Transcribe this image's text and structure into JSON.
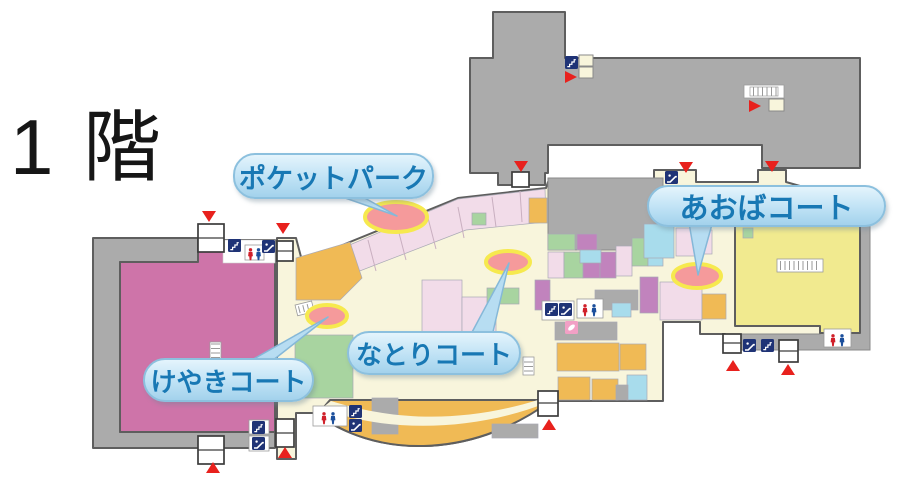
{
  "floor_map": {
    "title": "1 階",
    "courts": [
      {
        "id": "pocket-park",
        "label": "ポケットパーク"
      },
      {
        "id": "aoba-court",
        "label": "あおばコート"
      },
      {
        "id": "natori-court",
        "label": "なとりコート"
      },
      {
        "id": "keyaki-court",
        "label": "けやきコート"
      }
    ],
    "icons": [
      "stairs-icon",
      "escalator-icon",
      "toilet-icon",
      "nursing-room-icon",
      "stairwell-icon",
      "entrance-arrow-icon",
      "entrance-vestibule"
    ],
    "colors": {
      "anchor_gray": "#ABABAB",
      "corridor_cream": "#F8F5DC",
      "store_pink": "#CE74A9",
      "store_yellow": "#F1EA8F",
      "shop_light_pink": "#F2DCE9",
      "shop_purple": "#C183BD",
      "shop_green": "#A8D4A0",
      "shop_orange": "#F0BA55",
      "shop_light_blue": "#A8DCEC",
      "court_ellipse_fill": "#F59A9B",
      "court_ellipse_stroke": "#F6E94E",
      "bubble_text": "#1878B4",
      "entrance_red": "#E8211D",
      "icon_navy": "#1F3376",
      "nursing_pink": "#F2A0C5"
    }
  }
}
